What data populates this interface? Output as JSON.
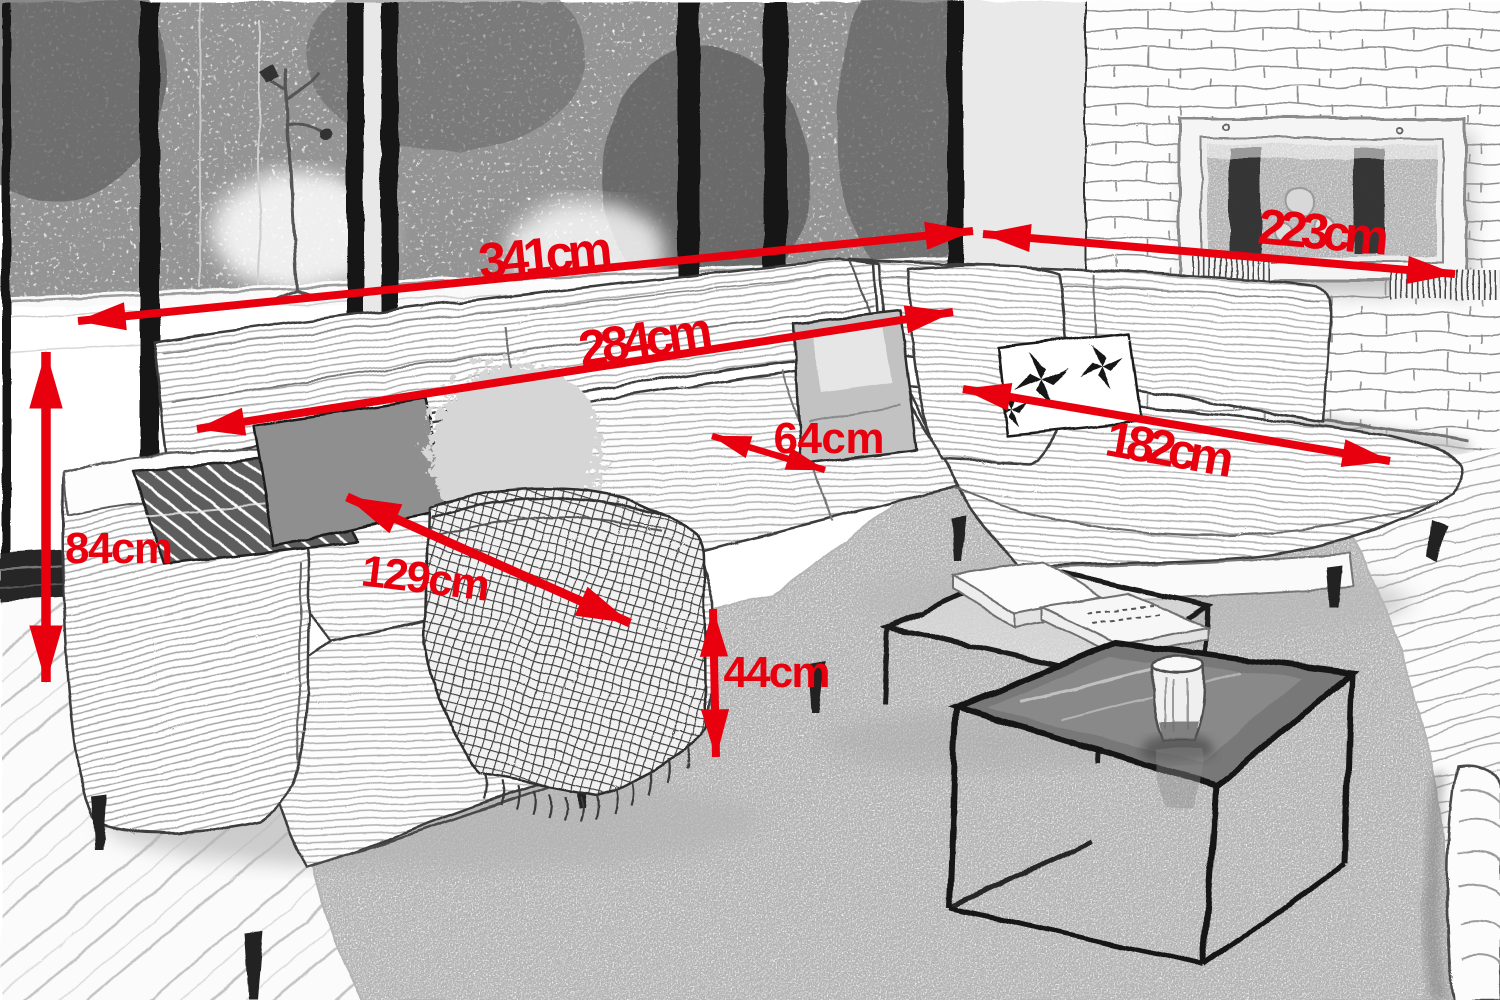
{
  "arrow_color": "#e9000f",
  "sketch_line_color": "#3d3d3d",
  "measurements": [
    {
      "id": "total-width",
      "label": "341cm"
    },
    {
      "id": "back-section-width",
      "label": "284cm"
    },
    {
      "id": "right-section-depth",
      "label": "223cm"
    },
    {
      "id": "seat-depth",
      "label": "64cm"
    },
    {
      "id": "right-chaise-length",
      "label": "182cm"
    },
    {
      "id": "overall-height",
      "label": "84cm"
    },
    {
      "id": "left-chaise-length",
      "label": "129cm"
    },
    {
      "id": "seat-height",
      "label": "44cm"
    }
  ]
}
